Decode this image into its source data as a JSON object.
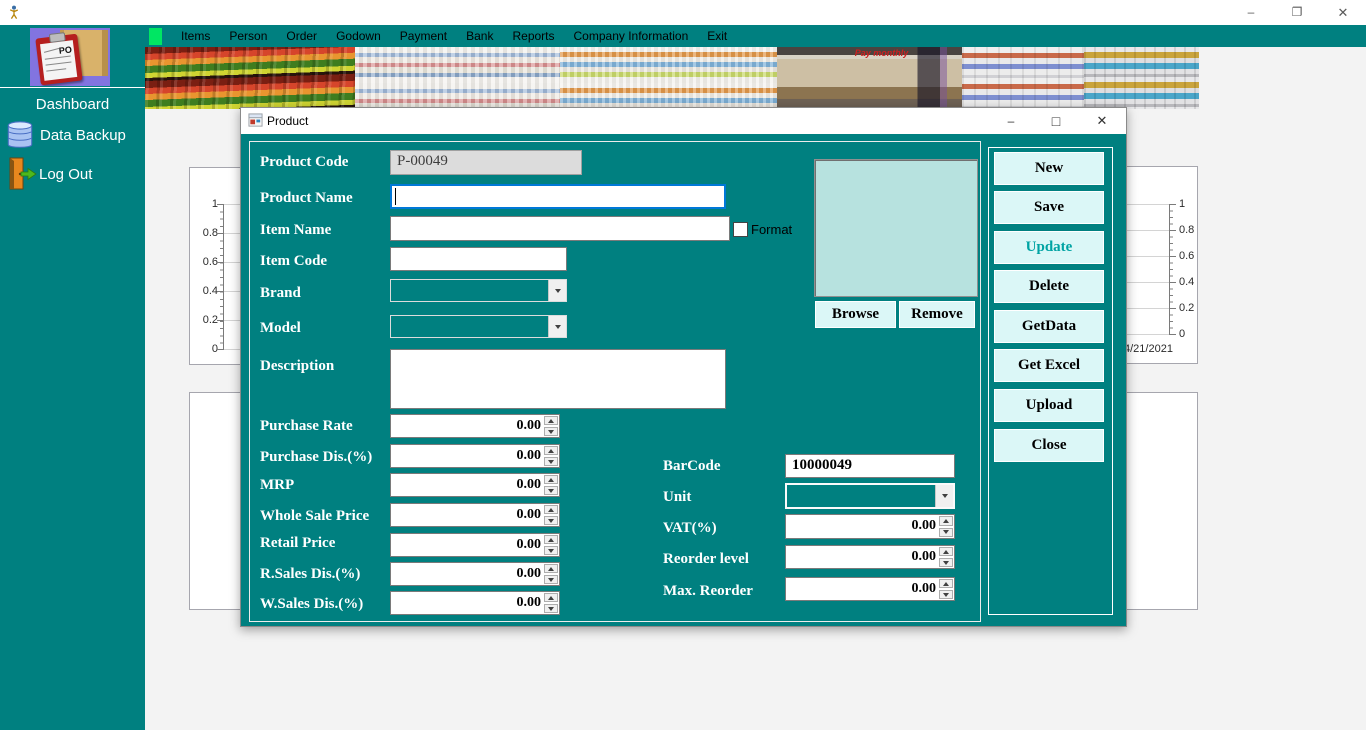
{
  "window": {
    "title": "",
    "icons": {
      "minimize": "–",
      "restore": "❐",
      "maximize": "□",
      "close": "✕"
    }
  },
  "sidebar": {
    "logo_text": "PO",
    "items": [
      {
        "label": "Dashboard"
      },
      {
        "label": "Data Backup"
      },
      {
        "label": "Log Out"
      }
    ]
  },
  "menubar": {
    "items": [
      "Items",
      "Person",
      "Order",
      "Godown",
      "Payment",
      "Bank",
      "Reports",
      "Company Information",
      "Exit"
    ]
  },
  "banner": {
    "phone_store_caption": "Pay monthly"
  },
  "charts": {
    "left": {
      "y_ticks": [
        "1",
        "0.8",
        "0.6",
        "0.4",
        "0.2",
        "0"
      ]
    },
    "right": {
      "y_ticks": [
        "1",
        "0.8",
        "0.6",
        "0.4",
        "0.2",
        "0"
      ],
      "x_label": "4/21/2021"
    }
  },
  "dialog": {
    "title": "Product",
    "fields": {
      "product_code": {
        "label": "Product Code",
        "value": "P-00049"
      },
      "product_name": {
        "label": "Product Name",
        "value": ""
      },
      "item_name": {
        "label": "Item Name",
        "value": ""
      },
      "format": {
        "label": "Format",
        "checked": false
      },
      "item_code": {
        "label": "Item Code",
        "value": ""
      },
      "brand": {
        "label": "Brand",
        "value": ""
      },
      "model": {
        "label": "Model",
        "value": ""
      },
      "description": {
        "label": "Description",
        "value": ""
      },
      "purchase_rate": {
        "label": "Purchase Rate",
        "value": "0.00"
      },
      "purchase_dis": {
        "label": "Purchase Dis.(%)",
        "value": "0.00"
      },
      "mrp": {
        "label": "MRP",
        "value": "0.00"
      },
      "whole_sale_price": {
        "label": "Whole Sale Price",
        "value": "0.00"
      },
      "retail_price": {
        "label": "Retail Price",
        "value": "0.00"
      },
      "r_sales_dis": {
        "label": "R.Sales Dis.(%)",
        "value": "0.00"
      },
      "w_sales_dis": {
        "label": "W.Sales Dis.(%)",
        "value": "0.00"
      },
      "barcode": {
        "label": "BarCode",
        "value": "10000049"
      },
      "unit": {
        "label": "Unit",
        "value": ""
      },
      "vat": {
        "label": "VAT(%)",
        "value": "0.00"
      },
      "reorder_level": {
        "label": "Reorder level",
        "value": "0.00"
      },
      "max_reorder": {
        "label": "Max. Reorder",
        "value": "0.00"
      }
    },
    "image_buttons": [
      {
        "label": "Browse"
      },
      {
        "label": "Remove"
      }
    ],
    "action_buttons": [
      {
        "label": "New"
      },
      {
        "label": "Save"
      },
      {
        "label": "Update"
      },
      {
        "label": "Delete"
      },
      {
        "label": "GetData"
      },
      {
        "label": "Get Excel"
      },
      {
        "label": "Upload"
      },
      {
        "label": "Close"
      }
    ]
  },
  "colors": {
    "teal": "#008080",
    "button_bg": "#dbf7f7",
    "update_text": "#00a3a3",
    "image_box": "#b7e2df",
    "focus_border": "#0078d7",
    "menu_badge": "#00e663"
  }
}
